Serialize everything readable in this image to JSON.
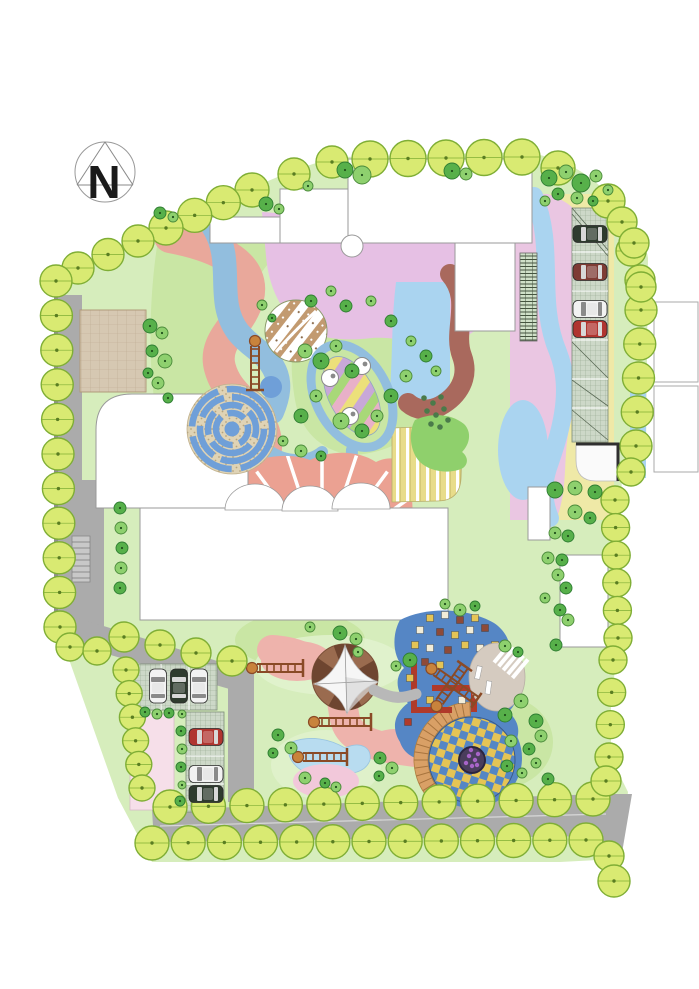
{
  "compass": {
    "label": "N"
  },
  "palette": {
    "lawn": "#d6edbc",
    "lawnMid": "#c9e6a4",
    "lawnLight": "#e2f2d0",
    "road": "#ababab",
    "roadDark": "#909090",
    "roadLine": "#d8d8d8",
    "salmon": "#e9a89b",
    "pinkPath": "#eeb3ac",
    "purple": "#e6c0e4",
    "pinkLight": "#eac6e2",
    "blueBand": "#92bede",
    "lightBlue": "#aad4f0",
    "brown": "#a9695d",
    "yellow": "#efe9a7",
    "mosaicBlue": "#5586c5",
    "mazeBlue": "#6f9fd8",
    "mazeBase": "#dfd3b5",
    "fanPink": "#eba192",
    "deckYellow": "#e8dc8a",
    "greenBlob": "#8fd06c",
    "treeBorderFill": "#d9ea72",
    "treeBorderStroke": "#7fae35",
    "treeDark": "#57b04a",
    "treeDarkStroke": "#2e7d32",
    "treeMid": "#8ed06e",
    "tan": "#d5cbc0",
    "stair": "#d9a066",
    "tentBrown": "#9a6b4f",
    "tentDark": "#6e4530",
    "pinkPlaza": "#f6dfe9",
    "pondBlue": "#b8dcf0",
    "pondPink": "#f2c8da",
    "paverBase": "#cdd8c8",
    "paverLine": "#96a890",
    "brickBase": "#d6c8b2",
    "brickLine": "#bcab90",
    "pergola": "#cfe0c8",
    "pergolaLine": "#44543f",
    "ladderBrown": "#8a4a26",
    "ladderKnob": "#c8833c"
  },
  "carColors": {
    "dark": "#2e3b2e",
    "maroon": "#7e3b34",
    "white": "#f2f2f2",
    "red": "#b03530"
  },
  "tileColors": {
    "y": "#e5c455",
    "w": "#f2ecd8",
    "b": "#8e4a38",
    "r": "#b03a2a"
  },
  "borderTrees": {
    "chains": [
      [
        252,
        190,
        166,
        228,
        4,
        17
      ],
      [
        138,
        241,
        78,
        268,
        3,
        16
      ],
      [
        294,
        174,
        332,
        162,
        2,
        16
      ],
      [
        370,
        159,
        522,
        157,
        5,
        18
      ],
      [
        558,
        168,
        608,
        201,
        2,
        17
      ],
      [
        622,
        222,
        640,
        280,
        3,
        15
      ],
      [
        641,
        310,
        636,
        446,
        5,
        16
      ],
      [
        615,
        500,
        618,
        638,
        6,
        14
      ],
      [
        56,
        281,
        60,
        627,
        11,
        16
      ],
      [
        70,
        647,
        97,
        651,
        2,
        14
      ],
      [
        124,
        637,
        232,
        661,
        4,
        15
      ],
      [
        126,
        670,
        142,
        788,
        6,
        13
      ],
      [
        170,
        807,
        593,
        799,
        12,
        17
      ],
      [
        152,
        843,
        586,
        840,
        13,
        17
      ],
      [
        613,
        660,
        609,
        757,
        4,
        14
      ]
    ],
    "singles": [
      [
        634,
        243,
        15
      ],
      [
        641,
        287,
        15
      ],
      [
        631,
        472,
        14
      ],
      [
        606,
        781,
        15
      ],
      [
        609,
        856,
        15
      ],
      [
        614,
        881,
        16
      ]
    ]
  },
  "scatterTrees": [
    [
      345,
      170,
      8,
      "d"
    ],
    [
      362,
      175,
      9,
      "m"
    ],
    [
      452,
      171,
      8,
      "d"
    ],
    [
      466,
      174,
      6,
      "m"
    ],
    [
      266,
      204,
      7,
      "d"
    ],
    [
      279,
      209,
      5,
      "m"
    ],
    [
      160,
      213,
      6,
      "d"
    ],
    [
      173,
      217,
      5,
      "m"
    ],
    [
      308,
      186,
      5,
      "m"
    ],
    [
      549,
      178,
      8,
      "d"
    ],
    [
      566,
      172,
      7,
      "m"
    ],
    [
      581,
      183,
      9,
      "d"
    ],
    [
      596,
      176,
      6,
      "m"
    ],
    [
      558,
      194,
      6,
      "d"
    ],
    [
      577,
      198,
      6,
      "m"
    ],
    [
      545,
      201,
      5,
      "m"
    ],
    [
      593,
      201,
      5,
      "d"
    ],
    [
      608,
      190,
      5,
      "m"
    ],
    [
      150,
      326,
      7,
      "d"
    ],
    [
      162,
      333,
      6,
      "m"
    ],
    [
      152,
      351,
      6,
      "d"
    ],
    [
      165,
      361,
      7,
      "m"
    ],
    [
      148,
      373,
      5,
      "d"
    ],
    [
      158,
      383,
      6,
      "m"
    ],
    [
      168,
      398,
      5,
      "d"
    ],
    [
      305,
      351,
      7,
      "m"
    ],
    [
      321,
      361,
      8,
      "d"
    ],
    [
      336,
      346,
      6,
      "m"
    ],
    [
      352,
      371,
      7,
      "d"
    ],
    [
      316,
      396,
      6,
      "m"
    ],
    [
      301,
      416,
      7,
      "d"
    ],
    [
      341,
      421,
      8,
      "m"
    ],
    [
      362,
      431,
      7,
      "d"
    ],
    [
      377,
      416,
      6,
      "m"
    ],
    [
      391,
      396,
      7,
      "d"
    ],
    [
      406,
      376,
      6,
      "m"
    ],
    [
      346,
      306,
      6,
      "d"
    ],
    [
      331,
      291,
      5,
      "m"
    ],
    [
      311,
      301,
      6,
      "d"
    ],
    [
      371,
      301,
      5,
      "m"
    ],
    [
      391,
      321,
      6,
      "d"
    ],
    [
      411,
      341,
      5,
      "m"
    ],
    [
      426,
      356,
      6,
      "d"
    ],
    [
      301,
      451,
      6,
      "m"
    ],
    [
      321,
      456,
      5,
      "d"
    ],
    [
      283,
      441,
      5,
      "m"
    ],
    [
      436,
      371,
      5,
      "m"
    ],
    [
      262,
      305,
      5,
      "m"
    ],
    [
      272,
      318,
      4,
      "d"
    ],
    [
      555,
      490,
      8,
      "d"
    ],
    [
      575,
      488,
      7,
      "m"
    ],
    [
      595,
      492,
      7,
      "d"
    ],
    [
      575,
      512,
      7,
      "m"
    ],
    [
      590,
      518,
      6,
      "d"
    ],
    [
      555,
      533,
      6,
      "m"
    ],
    [
      568,
      536,
      6,
      "d"
    ],
    [
      548,
      558,
      6,
      "m"
    ],
    [
      562,
      560,
      6,
      "d"
    ],
    [
      558,
      575,
      6,
      "m"
    ],
    [
      566,
      588,
      6,
      "d"
    ],
    [
      545,
      598,
      5,
      "m"
    ],
    [
      560,
      610,
      6,
      "d"
    ],
    [
      568,
      620,
      6,
      "m"
    ],
    [
      556,
      645,
      6,
      "d"
    ],
    [
      120,
      508,
      6,
      "d"
    ],
    [
      121,
      528,
      6,
      "m"
    ],
    [
      122,
      548,
      6,
      "d"
    ],
    [
      121,
      568,
      6,
      "m"
    ],
    [
      120,
      588,
      6,
      "d"
    ],
    [
      145,
      712,
      5,
      "d"
    ],
    [
      157,
      714,
      5,
      "m"
    ],
    [
      169,
      713,
      5,
      "d"
    ],
    [
      182,
      714,
      4,
      "m"
    ],
    [
      181,
      731,
      5,
      "d"
    ],
    [
      182,
      749,
      5,
      "m"
    ],
    [
      181,
      767,
      5,
      "d"
    ],
    [
      182,
      785,
      4,
      "m"
    ],
    [
      180,
      801,
      5,
      "d"
    ],
    [
      340,
      633,
      7,
      "d"
    ],
    [
      356,
      639,
      6,
      "m"
    ],
    [
      310,
      627,
      5,
      "m"
    ],
    [
      410,
      660,
      7,
      "d"
    ],
    [
      396,
      666,
      5,
      "m"
    ],
    [
      278,
      735,
      6,
      "d"
    ],
    [
      291,
      748,
      6,
      "m"
    ],
    [
      273,
      753,
      5,
      "d"
    ],
    [
      305,
      778,
      6,
      "m"
    ],
    [
      325,
      783,
      5,
      "d"
    ],
    [
      336,
      787,
      5,
      "m"
    ],
    [
      380,
      758,
      6,
      "d"
    ],
    [
      392,
      768,
      6,
      "m"
    ],
    [
      379,
      776,
      5,
      "d"
    ],
    [
      505,
      715,
      7,
      "d"
    ],
    [
      521,
      701,
      7,
      "m"
    ],
    [
      536,
      721,
      7,
      "d"
    ],
    [
      511,
      741,
      6,
      "m"
    ],
    [
      529,
      749,
      6,
      "d"
    ],
    [
      541,
      736,
      6,
      "m"
    ],
    [
      507,
      766,
      6,
      "d"
    ],
    [
      522,
      773,
      5,
      "m"
    ],
    [
      548,
      779,
      6,
      "d"
    ],
    [
      536,
      763,
      5,
      "m"
    ],
    [
      460,
      610,
      6,
      "m"
    ],
    [
      475,
      606,
      5,
      "d"
    ],
    [
      445,
      604,
      5,
      "m"
    ],
    [
      358,
      652,
      5,
      "m"
    ],
    [
      505,
      646,
      6,
      "m"
    ],
    [
      518,
      652,
      5,
      "d"
    ]
  ],
  "cars": [
    [
      590,
      234,
      0,
      "dark"
    ],
    [
      590,
      272,
      0,
      "maroon"
    ],
    [
      590,
      309,
      0,
      "white"
    ],
    [
      590,
      329,
      0,
      "red"
    ],
    [
      158,
      686,
      90,
      "white"
    ],
    [
      179,
      686,
      90,
      "dark"
    ],
    [
      199,
      686,
      90,
      "white"
    ],
    [
      206,
      737,
      0,
      "red"
    ],
    [
      206,
      774,
      0,
      "white"
    ],
    [
      206,
      794,
      0,
      "dark"
    ]
  ],
  "mosaicTiles": [
    [
      430,
      618,
      "y"
    ],
    [
      445,
      615,
      "w"
    ],
    [
      460,
      620,
      "b"
    ],
    [
      475,
      618,
      "y"
    ],
    [
      420,
      630,
      "w"
    ],
    [
      440,
      632,
      "b"
    ],
    [
      455,
      635,
      "y"
    ],
    [
      470,
      630,
      "w"
    ],
    [
      485,
      628,
      "b"
    ],
    [
      415,
      645,
      "y"
    ],
    [
      430,
      648,
      "w"
    ],
    [
      448,
      650,
      "b"
    ],
    [
      465,
      645,
      "y"
    ],
    [
      480,
      648,
      "w"
    ],
    [
      495,
      645,
      "y"
    ],
    [
      425,
      662,
      "b"
    ],
    [
      440,
      665,
      "y"
    ],
    [
      490,
      662,
      "w"
    ],
    [
      410,
      678,
      "y"
    ],
    [
      500,
      680,
      "b"
    ],
    [
      415,
      695,
      "w"
    ],
    [
      430,
      700,
      "y"
    ],
    [
      495,
      700,
      "y"
    ],
    [
      505,
      690,
      "w"
    ],
    [
      408,
      722,
      "r"
    ],
    [
      462,
      700,
      "w"
    ]
  ],
  "ladders": [
    [
      280,
      668,
      0,
      46
    ],
    [
      345,
      722,
      0,
      52
    ],
    [
      325,
      757,
      0,
      44
    ],
    [
      255,
      368,
      90,
      44
    ],
    [
      456,
      686,
      35,
      50
    ],
    [
      452,
      684,
      -55,
      44
    ]
  ],
  "mazeRings": [
    [
      40,
      "68 9 55 10 46 9",
      -20
    ],
    [
      32,
      "42 8 34 9 30 8",
      35
    ],
    [
      24,
      "28 8 24 8 22 8",
      80
    ],
    [
      16,
      "22 7 18 7",
      150
    ]
  ],
  "stairArc": {
    "cx": 472,
    "cy": 760,
    "r1": 44,
    "r2": 58,
    "a1": 132,
    "a2": 268,
    "lines": 17
  },
  "fanRays": {
    "cx": 322,
    "cy": 560,
    "r0": 26,
    "r1": 110,
    "a1": 197,
    "a2": 343,
    "n": 9
  },
  "zebra": {
    "cx": 511,
    "cy": 661,
    "n": 5,
    "len": 24,
    "gap": 6,
    "angle": 40
  },
  "pondTables": [
    [
      330,
      378
    ],
    [
      362,
      366
    ],
    [
      350,
      416
    ]
  ],
  "dotCluster": [
    [
      424,
      398
    ],
    [
      433,
      403
    ],
    [
      441,
      397
    ],
    [
      427,
      411
    ],
    [
      436,
      415
    ],
    [
      444,
      409
    ],
    [
      431,
      424
    ],
    [
      440,
      427
    ],
    [
      448,
      420
    ]
  ],
  "flowerDots": [
    [
      469,
      756
    ],
    [
      475,
      760
    ],
    [
      466,
      763
    ],
    [
      472,
      766
    ],
    [
      478,
      754
    ],
    [
      471,
      750
    ],
    [
      477,
      765
    ]
  ]
}
